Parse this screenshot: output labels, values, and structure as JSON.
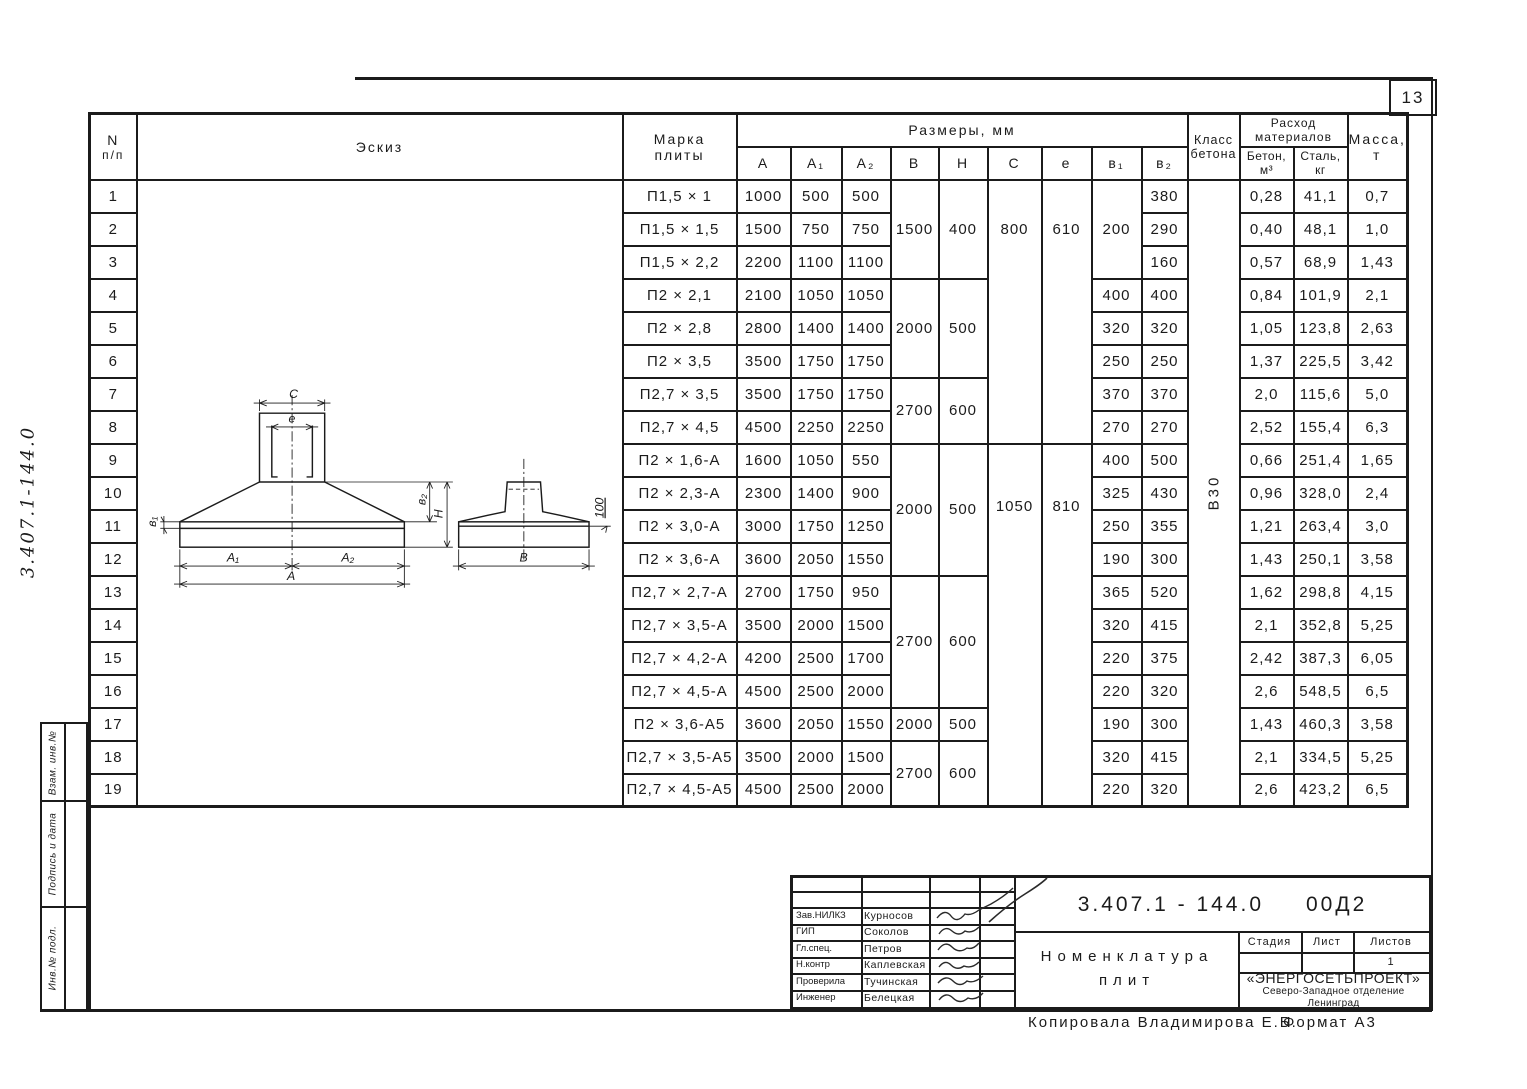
{
  "page": {
    "number": "13",
    "side_doc_number": "3.407.1-144.0",
    "copied_by": "Копировала  Владимирова Е.Б.",
    "format": "Формат А3"
  },
  "side_strip": {
    "labels": [
      "Взам. инв.№",
      "Подпись и дата",
      "Инв.№ подл."
    ]
  },
  "sketch": {
    "labels": {
      "c": "C",
      "e": "e",
      "b1": "в₁",
      "b2": "в₂",
      "h": "H",
      "a1": "A₁",
      "a2": "A₂",
      "a": "A",
      "b": "B",
      "note": "100"
    }
  },
  "table": {
    "headers": {
      "num_top": "N",
      "num_bottom": "п/п",
      "sketch": "Эскиз",
      "mark_1": "Марка",
      "mark_2": "плиты",
      "sizes": "Размеры,  мм",
      "dims": [
        "A",
        "A₁",
        "A₂",
        "B",
        "H",
        "C",
        "e",
        "в₁",
        "в₂"
      ],
      "class_1": "Класс",
      "class_2": "бетона",
      "consumption_1": "Расход",
      "consumption_2": "материалов",
      "beton_1": "Бетон,",
      "beton_2": "м³",
      "stal_1": "Сталь,",
      "stal_2": "кг",
      "mass_1": "Масса,",
      "mass_2": "т"
    },
    "rows": [
      {
        "n": "1",
        "mark": "П1,5 × 1",
        "A": "1000",
        "A1": "500",
        "A2": "500",
        "B": {
          "v": "1500",
          "s": 3
        },
        "H": {
          "v": "400",
          "s": 3
        },
        "C": {
          "v": "800",
          "s": 8,
          "off": 1
        },
        "e": {
          "v": "610",
          "s": 8,
          "off": 1
        },
        "b1": {
          "v": "200",
          "s": 3
        },
        "b2": "380",
        "klass": {
          "v": "В30",
          "s": 19
        },
        "beton": "0,28",
        "stal": "41,1",
        "massa": "0,7"
      },
      {
        "n": "2",
        "mark": "П1,5 × 1,5",
        "A": "1500",
        "A1": "750",
        "A2": "750",
        "b2": "290",
        "beton": "0,40",
        "stal": "48,1",
        "massa": "1,0"
      },
      {
        "n": "3",
        "mark": "П1,5 × 2,2",
        "A": "2200",
        "A1": "1100",
        "A2": "1100",
        "b2": "160",
        "beton": "0,57",
        "stal": "68,9",
        "massa": "1,43"
      },
      {
        "n": "4",
        "mark": "П2 × 2,1",
        "A": "2100",
        "A1": "1050",
        "A2": "1050",
        "B": {
          "v": "2000",
          "s": 3
        },
        "H": {
          "v": "500",
          "s": 3
        },
        "b1": "400",
        "b2": "400",
        "beton": "0,84",
        "stal": "101,9",
        "massa": "2,1"
      },
      {
        "n": "5",
        "mark": "П2 × 2,8",
        "A": "2800",
        "A1": "1400",
        "A2": "1400",
        "b1": "320",
        "b2": "320",
        "beton": "1,05",
        "stal": "123,8",
        "massa": "2,63"
      },
      {
        "n": "6",
        "mark": "П2 × 3,5",
        "A": "3500",
        "A1": "1750",
        "A2": "1750",
        "b1": "250",
        "b2": "250",
        "beton": "1,37",
        "stal": "225,5",
        "massa": "3,42"
      },
      {
        "n": "7",
        "mark": "П2,7 × 3,5",
        "A": "3500",
        "A1": "1750",
        "A2": "1750",
        "B": {
          "v": "2700",
          "s": 2
        },
        "H": {
          "v": "600",
          "s": 2
        },
        "b1": "370",
        "b2": "370",
        "beton": "2,0",
        "stal": "115,6",
        "massa": "5,0"
      },
      {
        "n": "8",
        "mark": "П2,7 × 4,5",
        "A": "4500",
        "A1": "2250",
        "A2": "2250",
        "b1": "270",
        "b2": "270",
        "beton": "2,52",
        "stal": "155,4",
        "massa": "6,3"
      },
      {
        "n": "9",
        "mark": "П2 × 1,6-А",
        "A": "1600",
        "A1": "1050",
        "A2": "550",
        "B": {
          "v": "2000",
          "s": 4
        },
        "H": {
          "v": "500",
          "s": 4
        },
        "C": {
          "v": "1050",
          "s": 11,
          "off": 1.4
        },
        "e": {
          "v": "810",
          "s": 11,
          "off": 1.4
        },
        "b1": "400",
        "b2": "500",
        "beton": "0,66",
        "stal": "251,4",
        "massa": "1,65"
      },
      {
        "n": "10",
        "mark": "П2 × 2,3-А",
        "A": "2300",
        "A1": "1400",
        "A2": "900",
        "b1": "325",
        "b2": "430",
        "beton": "0,96",
        "stal": "328,0",
        "massa": "2,4"
      },
      {
        "n": "11",
        "mark": "П2 × 3,0-А",
        "A": "3000",
        "A1": "1750",
        "A2": "1250",
        "b1": "250",
        "b2": "355",
        "beton": "1,21",
        "stal": "263,4",
        "massa": "3,0"
      },
      {
        "n": "12",
        "mark": "П2 × 3,6-А",
        "A": "3600",
        "A1": "2050",
        "A2": "1550",
        "b1": "190",
        "b2": "300",
        "beton": "1,43",
        "stal": "250,1",
        "massa": "3,58"
      },
      {
        "n": "13",
        "mark": "П2,7 × 2,7-А",
        "A": "2700",
        "A1": "1750",
        "A2": "950",
        "B": {
          "v": "2700",
          "s": 4
        },
        "H": {
          "v": "600",
          "s": 4
        },
        "b1": "365",
        "b2": "520",
        "beton": "1,62",
        "stal": "298,8",
        "massa": "4,15"
      },
      {
        "n": "14",
        "mark": "П2,7 × 3,5-А",
        "A": "3500",
        "A1": "2000",
        "A2": "1500",
        "b1": "320",
        "b2": "415",
        "beton": "2,1",
        "stal": "352,8",
        "massa": "5,25"
      },
      {
        "n": "15",
        "mark": "П2,7 × 4,2-А",
        "A": "4200",
        "A1": "2500",
        "A2": "1700",
        "b1": "220",
        "b2": "375",
        "beton": "2,42",
        "stal": "387,3",
        "massa": "6,05"
      },
      {
        "n": "16",
        "mark": "П2,7 × 4,5-А",
        "A": "4500",
        "A1": "2500",
        "A2": "2000",
        "b1": "220",
        "b2": "320",
        "beton": "2,6",
        "stal": "548,5",
        "massa": "6,5"
      },
      {
        "n": "17",
        "mark": "П2 × 3,6-А5",
        "A": "3600",
        "A1": "2050",
        "A2": "1550",
        "B": "2000",
        "H": "500",
        "b1": "190",
        "b2": "300",
        "beton": "1,43",
        "stal": "460,3",
        "massa": "3,58"
      },
      {
        "n": "18",
        "mark": "П2,7 × 3,5-А5",
        "A": "3500",
        "A1": "2000",
        "A2": "1500",
        "B": {
          "v": "2700",
          "s": 2
        },
        "H": {
          "v": "600",
          "s": 2
        },
        "b1": "320",
        "b2": "415",
        "beton": "2,1",
        "stal": "334,5",
        "massa": "5,25"
      },
      {
        "n": "19",
        "mark": "П2,7 × 4,5-А5",
        "A": "4500",
        "A1": "2500",
        "A2": "2000",
        "b1": "220",
        "b2": "320",
        "beton": "2,6",
        "stal": "423,2",
        "massa": "6,5"
      }
    ]
  },
  "stamp": {
    "doc_number": "3.407.1 - 144.0",
    "doc_code": "00Д2",
    "title_1": "Номенклатура",
    "title_2": "плит",
    "people": [
      {
        "role": "Зав.НИЛКЗ",
        "name": "Курносов"
      },
      {
        "role": "ГИП",
        "name": "Соколов"
      },
      {
        "role": "Гл.спец.",
        "name": "Петров"
      },
      {
        "role": "Н.контр",
        "name": "Каплевская"
      },
      {
        "role": "Проверила",
        "name": "Тучинская"
      },
      {
        "role": "Инженер",
        "name": "Белецкая"
      }
    ],
    "stage_label": "Стадия",
    "sheet_label": "Лист",
    "sheets_label": "Листов",
    "sheets_value": "1",
    "org_1": "«ЭНЕРГОСЕТЬПРОЕКТ»",
    "org_2": "Северо-Западное отделение",
    "org_3": "Ленинград"
  }
}
